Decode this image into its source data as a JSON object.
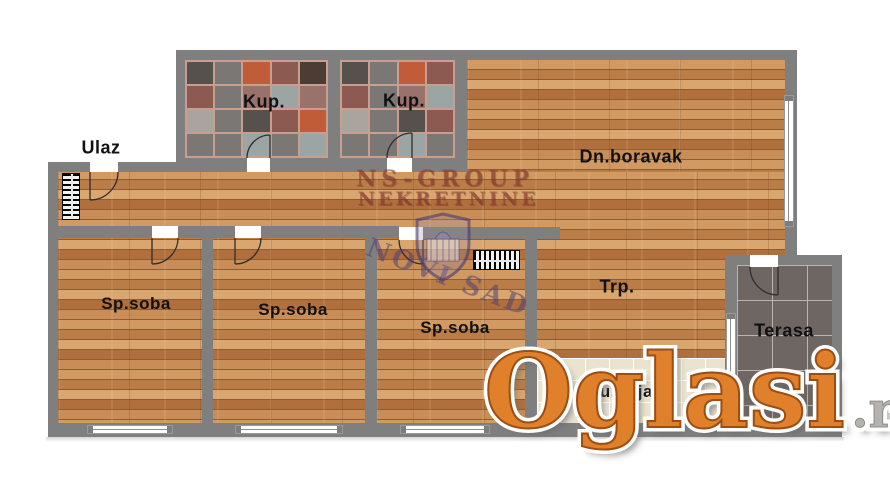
{
  "page": {
    "width": 890,
    "height": 482,
    "background": "#ffffff"
  },
  "rooms": {
    "ulaz": {
      "label": "Ulaz"
    },
    "kup1": {
      "label": "Kup."
    },
    "kup2": {
      "label": "Kup."
    },
    "dnboravak": {
      "label": "Dn.boravak"
    },
    "spsoba1": {
      "label": "Sp.soba"
    },
    "spsoba2": {
      "label": "Sp.soba"
    },
    "spsoba3": {
      "label": "Sp.soba"
    },
    "trp": {
      "label": "Trp."
    },
    "kuhinja": {
      "label": "Kuhinja"
    },
    "terasa": {
      "label": "Terasa"
    }
  },
  "watermark": {
    "agency_line1": "NS-GROUP",
    "agency_line2": "NEKRETNINE",
    "badge_text": "NOVI SAD"
  },
  "logo": {
    "name": "Oglasi",
    "tld": ".rs"
  },
  "colors": {
    "wall": "#7f7f7f",
    "wood": "#c4884f",
    "bath-grout": "#c79e8f",
    "kitchen-tile": "#eae3d0",
    "terrace-tile": "#6e6663",
    "label": "#111111",
    "watermark-red": "rgba(139,58,48,0.55)",
    "watermark-purple": "rgba(78,66,116,0.55)",
    "oglasi-orange": "#e0802a",
    "oglasi-stroke": "#9c4d12",
    "rs-grey": "#b5b3b0"
  },
  "bath_tile_palette": [
    "#57514d",
    "#9aa5a4",
    "#c05c38",
    "#99726c",
    "#4c3c33",
    "#7b7775",
    "#a9a49e",
    "#8c5a50"
  ]
}
